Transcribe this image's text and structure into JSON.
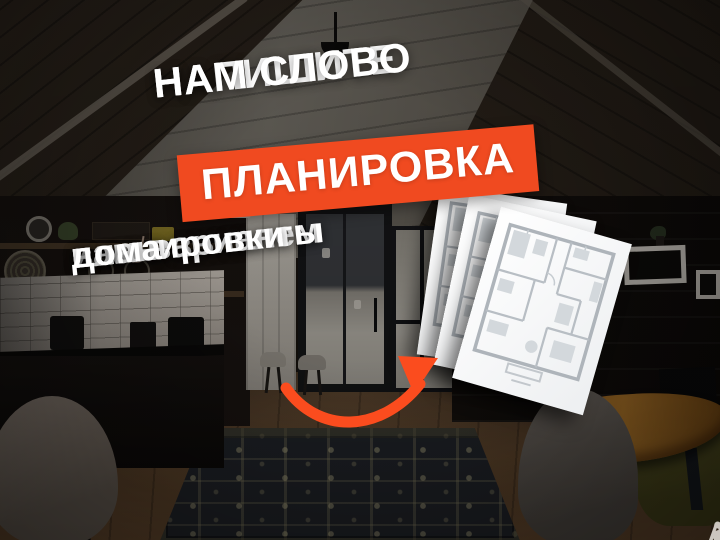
{
  "ad": {
    "headline": {
      "line1": "НАПИШИТЕ",
      "line2": "НАМ СЛОВО"
    },
    "keyword": "ПЛАНИРОВКА",
    "subtext": [
      "и мы вышлем",
      "вам варианты",
      "планировки",
      "дома"
    ],
    "floor_plan_sheets_visible": 3,
    "colors": {
      "banner": "#F04A20",
      "arrow": "#FB4C1E",
      "text": "#FFFFFF"
    },
    "icons": {
      "arrow": "curved-arrow-icon",
      "floor_plan": "floor-plan-sheet"
    }
  },
  "watermark": {
    "brand": "Avito",
    "logo": "avito-four-dots-icon"
  }
}
